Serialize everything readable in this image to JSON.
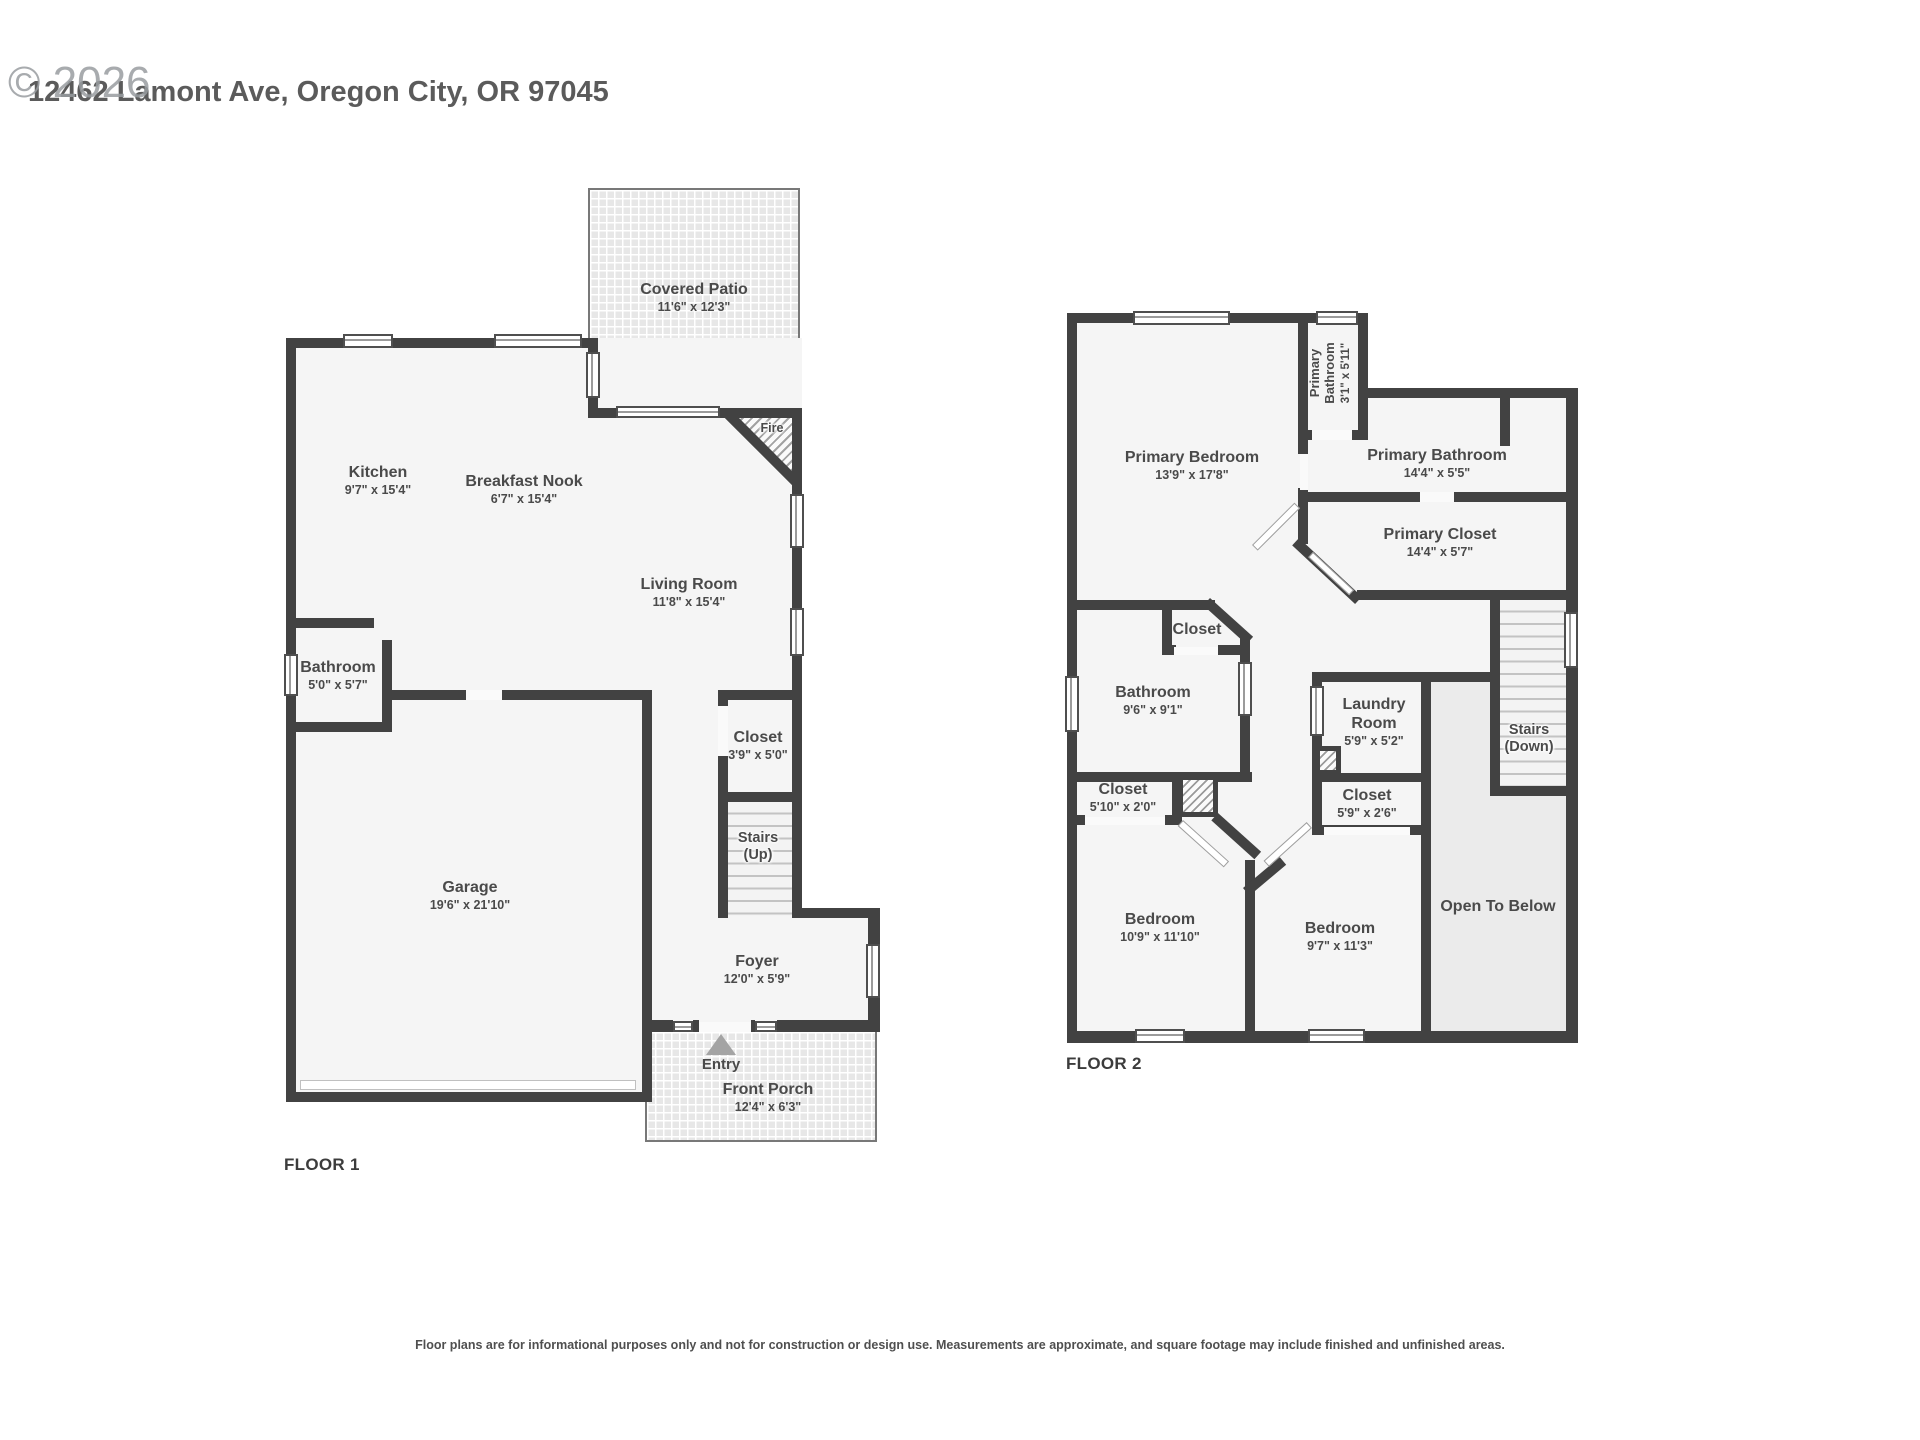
{
  "header": {
    "watermark": "© 2026",
    "address": "12462 Lamont Ave, Oregon City, OR 97045"
  },
  "palette": {
    "wall": "#424242",
    "room_fill": "#f5f5f5",
    "open_fill": "#ebebeb",
    "texture_fill": "#e7e7e7",
    "text": "#4a4a4a"
  },
  "floor1": {
    "label": "FLOOR 1",
    "covered_patio": {
      "name": "Covered Patio",
      "dims": "11'6\" x 12'3\""
    },
    "kitchen": {
      "name": "Kitchen",
      "dims": "9'7\" x 15'4\""
    },
    "breakfast_nook": {
      "name": "Breakfast Nook",
      "dims": "6'7\" x 15'4\""
    },
    "living_room": {
      "name": "Living Room",
      "dims": "11'8\" x 15'4\""
    },
    "fire": {
      "name": "Fire"
    },
    "bathroom": {
      "name": "Bathroom",
      "dims": "5'0\" x 5'7\""
    },
    "garage": {
      "name": "Garage",
      "dims": "19'6\" x 21'10\""
    },
    "closet": {
      "name": "Closet",
      "dims": "3'9\" x 5'0\""
    },
    "stairs": {
      "name": "Stairs",
      "name2": "(Up)"
    },
    "foyer": {
      "name": "Foyer",
      "dims": "12'0\" x 5'9\""
    },
    "entry": {
      "name": "Entry"
    },
    "front_porch": {
      "name": "Front Porch",
      "dims": "12'4\" x 6'3\""
    }
  },
  "floor2": {
    "label": "FLOOR 2",
    "primary_bedroom": {
      "name": "Primary Bedroom",
      "dims": "13'9\" x 17'8\""
    },
    "primary_bathroom_small": {
      "name": "Primary Bathroom",
      "dims": "3'1\" x 5'11\""
    },
    "primary_bathroom": {
      "name": "Primary Bathroom",
      "dims": "14'4\" x 5'5\""
    },
    "primary_closet": {
      "name": "Primary Closet",
      "dims": "14'4\" x 5'7\""
    },
    "closet_hall": {
      "name": "Closet"
    },
    "bathroom": {
      "name": "Bathroom",
      "dims": "9'6\" x 9'1\""
    },
    "laundry": {
      "name": "Laundry Room",
      "dims": "5'9\" x 5'2\""
    },
    "stairs": {
      "name": "Stairs",
      "name2": "(Down)"
    },
    "closet_left": {
      "name": "Closet",
      "dims": "5'10\" x 2'0\""
    },
    "closet_right": {
      "name": "Closet",
      "dims": "5'9\" x 2'6\""
    },
    "bedroom_left": {
      "name": "Bedroom",
      "dims": "10'9\" x 11'10\""
    },
    "bedroom_right": {
      "name": "Bedroom",
      "dims": "9'7\" x 11'3\""
    },
    "open_to_below": {
      "name": "Open To Below"
    }
  },
  "footer": {
    "disclaimer": "Floor plans are for informational purposes only and not for construction or design use. Measurements are approximate, and square footage may include finished and unfinished areas."
  }
}
